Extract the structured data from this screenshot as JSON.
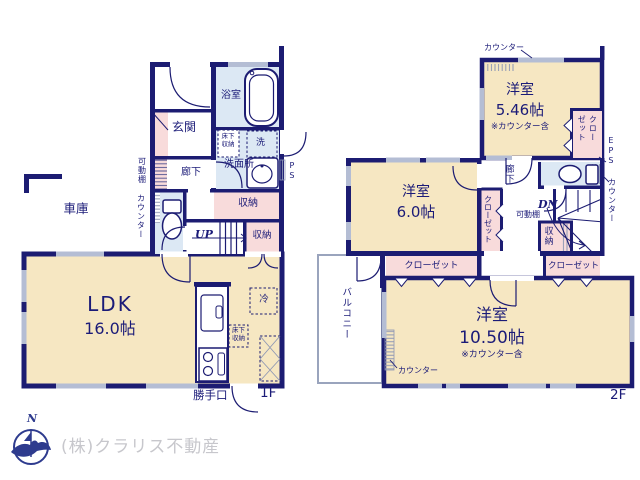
{
  "colors": {
    "wall": "#1c1c72",
    "floor_cream": "#f6e7c2",
    "wet_blue": "#dce8f4",
    "storage_pink": "#f8dbdb",
    "window_gray": "#b4bdd4",
    "text_navy": "#1b1b78",
    "logo_gray": "#c7c7cc",
    "compass_navy": "#2e3b8e"
  },
  "floor1": {
    "label": "1F",
    "garage": "車庫",
    "entrance": "玄関",
    "bathroom": "浴室",
    "washroom": "洗面所",
    "underfloor_storage": "床下収納",
    "washer": "洗",
    "hallway": "廊下",
    "movable_shelf": "可動棚",
    "counter": "カウンター",
    "pipe_space": "PS",
    "storage": "収納",
    "stairs_up": "UP",
    "ldk_name": "LDK",
    "ldk_size": "16.0帖",
    "fridge": "冷",
    "kitchen_underfloor_storage": "床下収納",
    "back_door": "勝手口"
  },
  "floor2": {
    "label": "2F",
    "counter": "カウンター",
    "room_a_name": "洋室",
    "room_a_size": "5.46帖",
    "room_a_note": "※カウンター含",
    "room_b_name": "洋室",
    "room_b_size": "6.0帖",
    "room_c_name": "洋室",
    "room_c_size": "10.50帖",
    "room_c_note": "※カウンター含",
    "closet": "クローゼット",
    "eps": "EPS",
    "hallway": "廊下",
    "stairs_down": "DN",
    "movable_shelf": "可動棚",
    "storage": "収納",
    "balcony": "バルコニー"
  },
  "footer": {
    "company": "(株)クラリス不動産",
    "compass_north": "N"
  }
}
